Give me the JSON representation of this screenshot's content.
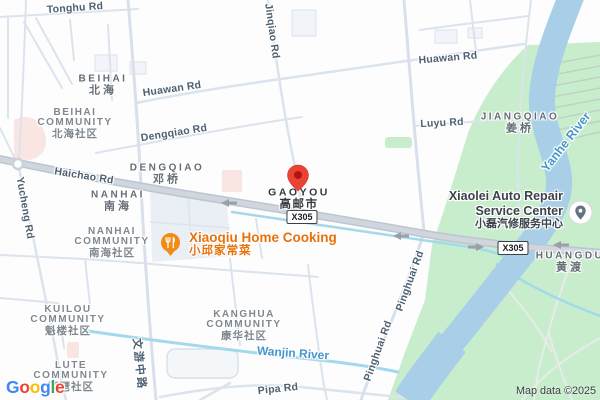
{
  "attribution": {
    "logo_letters": [
      "G",
      "o",
      "o",
      "g",
      "l",
      "e"
    ],
    "map_data_text": "Map data ©2025"
  },
  "marker": {
    "name": "GAOYOU",
    "name_zh": "高邮市"
  },
  "shield_label": "X305",
  "roads": {
    "tonghu": "Tonghu Rd",
    "jinqiao": "Jinqiao Rd",
    "huawan": "Huawan Rd",
    "dengqiao": "Dengqiao Rd",
    "luyu": "Luyu Rd",
    "haichao": "Haichao Rd",
    "yucheng": "Yucheng Rd",
    "wenyou_zh": "文游中路",
    "pinghuai": "Pinghuai Rd",
    "pipa": "Pipa Rd"
  },
  "waters": {
    "wanjin": "Wanjin River",
    "yanhe": "Yanhe River"
  },
  "localities": {
    "beihai": {
      "en": "BEIHAI",
      "zh": "北海"
    },
    "dengqiao": {
      "en": "DENGQIAO",
      "zh": "邓桥"
    },
    "nanhai": {
      "en": "NANHAI",
      "zh": "南海"
    },
    "jiangqiao": {
      "en": "JIANGQIAO",
      "zh": "姜桥"
    },
    "huangdu": {
      "en": "HUANGDU",
      "zh": "黄渡"
    }
  },
  "communities": {
    "beihai": {
      "l1": "BEIHAI",
      "l2": "COMMUNITY",
      "zh": "北海社区"
    },
    "nanhai": {
      "l1": "NANHAI",
      "l2": "COMMUNITY",
      "zh": "南海社区"
    },
    "kuilou": {
      "l1": "KUILOU",
      "l2": "COMMUNITY",
      "zh": "魁楼社区"
    },
    "lute": {
      "l1": "LUTE",
      "l2": "COMMUNITY",
      "zh": "琵琶社区"
    },
    "kanghua": {
      "l1": "KANGHUA",
      "l2": "COMMUNITY",
      "zh": "康华社区"
    }
  },
  "pois": {
    "xiaoqiu": {
      "name": "Xiaoqiu Home Cooking",
      "zh": "小邱家常菜"
    },
    "xiaolei": {
      "l1": "Xiaolei Auto Repair",
      "l2": "Service Center",
      "zh": "小磊汽修服务中心"
    }
  },
  "colors": {
    "poi_orange": "#E8710A",
    "water_label_blue": "#4497CB",
    "pin_red": "#EA4335",
    "pin_red_dark": "#B31412",
    "park_green": "#C8EDCC",
    "water_fill": "#A8CFE7",
    "major_road_gray": "#CBD2DB",
    "restaurant_icon_orange": "#F28B15",
    "auto_repair_icon_slate": "#65747E"
  }
}
